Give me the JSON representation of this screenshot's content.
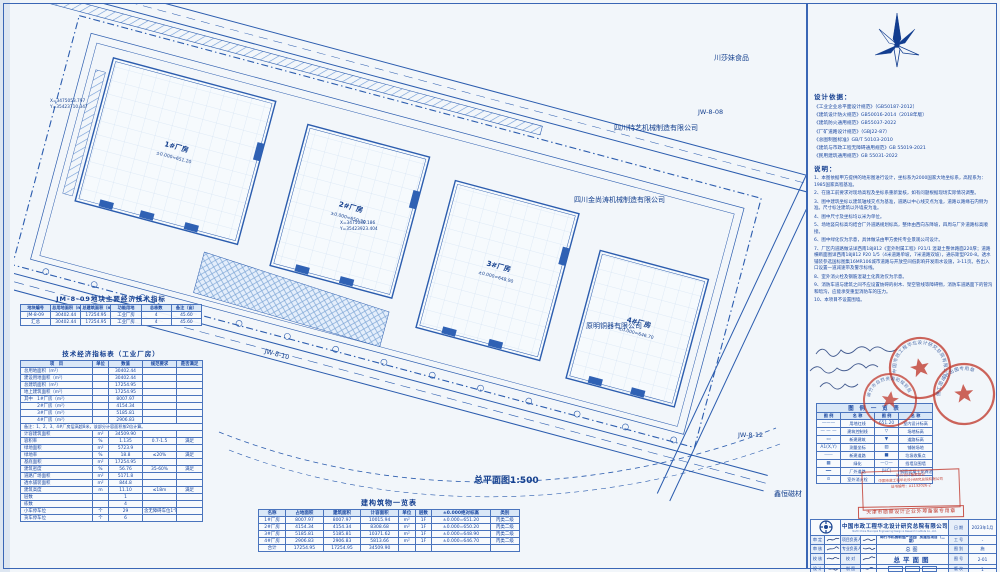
{
  "colors": {
    "line_blue": "#2b5cae",
    "text_navy": "#16418f",
    "stamp_red": "#c13a2e",
    "paper": "#f2f6fa"
  },
  "drawing": {
    "scale_label": "总平面图1:500",
    "neighbors": [
      "川莎妹食品",
      "四川特艺机械制造有限公司",
      "四川金尚涛机械制造有限公司",
      "原明铜器有限公司",
      "鑫恒磁材"
    ],
    "parcels": [
      "JW-8-08",
      "JW-8-10",
      "JW-8-12"
    ],
    "buildings": [
      {
        "name": "1#厂房",
        "elev": "±0.000=651.20"
      },
      {
        "name": "2#厂房",
        "elev": "±0.000=650.20"
      },
      {
        "name": "3#厂房",
        "elev": "±0.000=648.90"
      },
      {
        "name": "4#厂房",
        "elev": "±0.000=646.70"
      }
    ],
    "coords": [
      {
        "x": "X=3475053.797",
        "y": "Y=35423710.347"
      },
      {
        "x": "X=3475039.186",
        "y": "Y=35423923.404"
      }
    ]
  },
  "site_table": {
    "title": "JM-8-09地块主要经济技术指标",
    "headers": [
      "地块编号",
      "总用地面积（m²）",
      "总建筑面积（m²）",
      "功能用地",
      "总栋数",
      "备注（亩）"
    ],
    "rows": [
      [
        "JM-8-09",
        "30402.44",
        "17254.95",
        "工业厂房",
        "4",
        "45.60"
      ],
      [
        "汇总",
        "30402.44",
        "17254.95",
        "工业厂房",
        "4",
        "45.60"
      ]
    ]
  },
  "tech_table": {
    "title": "技术经济指标表（工业厂房）",
    "headers": [
      "项　目",
      "单位",
      "数值",
      "规范要求",
      "是否满足"
    ],
    "rows_a": [
      [
        "总用地面积（m²）",
        "",
        "30402.44",
        "",
        ""
      ],
      [
        "建设用地面积（m²）",
        "",
        "30402.44",
        "",
        ""
      ],
      [
        "总建筑面积（m²）",
        "",
        "17254.95",
        "",
        ""
      ],
      [
        "地上建筑面积（m²）",
        "",
        "17254.95",
        "",
        ""
      ],
      [
        "其中　1#厂房（m²）",
        "",
        "8007.97",
        "",
        ""
      ],
      [
        "　　　2#厂房（m²）",
        "",
        "4154.34",
        "",
        ""
      ],
      [
        "　　　3#厂房（m²）",
        "",
        "5185.81",
        "",
        ""
      ],
      [
        "　　　4#厂房（m²）",
        "",
        "2906.83",
        "",
        ""
      ]
    ],
    "note": "备注：1、2、3、4#厂房层高超8米，该部分计容面积按2倍计算。",
    "rows_b": [
      [
        "计容建筑面积",
        "m²",
        "34509.90",
        "",
        ""
      ],
      [
        "容积率",
        "%",
        "1.135",
        "0.7-1.5",
        "满足"
      ],
      [
        "绿地面积",
        "m²",
        "5723.9",
        "",
        ""
      ],
      [
        "绿地率",
        "%",
        "18.8",
        "≤20%",
        "满足"
      ],
      [
        "基底面积",
        "m²",
        "17254.95",
        "",
        ""
      ],
      [
        "建筑密度",
        "%",
        "56.76",
        "35-60%",
        "满足"
      ],
      [
        "道路广场面积",
        "m²",
        "5171.8",
        "",
        ""
      ],
      [
        "透水铺装面积",
        "m²",
        "844.8",
        "",
        ""
      ],
      [
        "建筑高度",
        "m",
        "11.10",
        "≤18m",
        "满足"
      ],
      [
        "层数",
        "",
        "1",
        "",
        ""
      ],
      [
        "栋数",
        "",
        "4",
        "",
        ""
      ],
      [
        "小车停车位",
        "个",
        "29",
        "含无障碍车位1个",
        ""
      ],
      [
        "货车停车位",
        "个",
        "6",
        "",
        ""
      ]
    ]
  },
  "building_table": {
    "title": "建构筑物一览表",
    "headers": [
      "名称",
      "占地面积",
      "建筑面积",
      "计容面积",
      "单位",
      "层数",
      "±0.000绝对标高",
      "类别"
    ],
    "rows": [
      [
        "1#厂房",
        "8007.97",
        "8007.97",
        "10015.94",
        "m²",
        "1F",
        "±0.000=651.20",
        "丙类二级"
      ],
      [
        "2#厂房",
        "4154.34",
        "4154.34",
        "8308.68",
        "m²",
        "1F",
        "±0.000=650.20",
        "丙类二级"
      ],
      [
        "3#厂房",
        "5185.81",
        "5185.81",
        "10371.62",
        "m²",
        "1F",
        "±0.000=648.90",
        "丙类二级"
      ],
      [
        "4#厂房",
        "2906.83",
        "2906.83",
        "5813.66",
        "m²",
        "1F",
        "±0.000=646.70",
        "丙类二级"
      ],
      [
        "合计",
        "17254.95",
        "17254.95",
        "34509.90",
        "",
        "",
        "",
        ""
      ]
    ]
  },
  "design_basis": {
    "title": "设计依据：",
    "items": [
      "《工业企业总平面设计规范》（GB50187-2012）",
      "《建筑设计防火规范》GB50016-2014（2018年版）",
      "《建筑防火通用规范》GB55037-2022",
      "《厂矿道路设计规范》（GBJ22-87）",
      "《总图制图标准》GB/T 50103-2010",
      "《建筑与市政工程无障碍通用规范》GB 55019-2021",
      "《民用建筑通用规范》GB 55031-2022"
    ]
  },
  "notes": {
    "title": "说明：",
    "items": [
      "1、本图依据甲方提供的地形图进行设计，坐标系为2000国家大地坐标系，高程系为：1985国家高程基准。",
      "2、在施工前要求对现场高程及坐标系重新复核，如有问题根据现场实际情况调整。",
      "3、图中建筑坐标以建筑轴线交点为基准，道路以中心线交点为准，道路以路缘石内侧为准。尺寸标注建筑以外墙皮为准。",
      "4、图中尺寸及坐标均以米为单位。",
      "5、场地竖向标高均结合厂外道路规划标高，整体由西向东降坡，四周与厂外道路标高顺接。",
      "6、图中绿化仅为示意，具体做法由甲方委托专业景观公司设计。",
      "7、厂区内道路做法详西南18J812《室外附属工程》P21/1 混凝土整体路面220厚；道路横断面图详西南18J812 P20 1/5（4米道路单坡，7米道路双坡），通乐斯型P20-8。透水铺装参选国标图集16MR106城市道路与开放空间低影响开发雨水设施，3-11页。各出入口设置一道减速带及警示标线。",
      "8、室外消火栓及钢筋混凝土化粪池仅为示意。",
      "9、消防车道与建筑之间不应设置妨碍的树木、架空管线等障碍物，消防车道路面下的管沟和暗沟，应能承受重型消防车的压力。",
      "10、本项目不设置围墙。"
    ]
  },
  "legend": {
    "title": "图 例 一 览 表",
    "headers": [
      "图 例",
      "名 称",
      "图 例",
      "名 称"
    ],
    "rows": [
      {
        "l_sym": "———",
        "l_name": "用地红线",
        "r_sym": "651.20",
        "r_name": "室内设计标高"
      },
      {
        "l_sym": "— — —",
        "l_name": "建筑控制线",
        "r_sym": "▽",
        "r_name": "场地标高"
      },
      {
        "l_sym": "▭",
        "l_name": "新建建筑",
        "r_sym": "▼",
        "r_name": "道路标高"
      },
      {
        "l_sym": "A1(X,Y)",
        "l_name": "测量坐标",
        "r_sym": "▨",
        "r_name": "铺装场地"
      },
      {
        "l_sym": "┄┄┄",
        "l_name": "新建道路",
        "r_sym": "■",
        "r_name": "垃圾收集点"
      },
      {
        "l_sym": "▩",
        "l_name": "绿化",
        "r_sym": "—○—",
        "r_name": "挡墙及围墙"
      },
      {
        "l_sym": "━━",
        "l_name": "厂外道路",
        "r_sym": "(HC)",
        "r_name": "钢筋混凝土化粪池"
      },
      {
        "l_sym": "⊙",
        "l_name": "室外消火栓",
        "r_sym": "",
        "r_name": ""
      }
    ]
  },
  "stamps": {
    "circle_texts": [
      "中国市政工程华北设计研究总院有限公司",
      "绵竹市自然资源和规划局",
      "施工图设计出图专用章"
    ],
    "box_lines": [
      "进川设计备案登记",
      "中国市政工程华北设计研究总院有限公司",
      "证书编号：A1132026-2"
    ],
    "bar_text": "天津市勘察设计企业外埠备案专用章"
  },
  "title_block": {
    "company": "中国市政工程华北设计研究总院有限公司",
    "company_en": "North China Municipal Engineering Design & Research Institute Co., Ltd.",
    "date_label": "日 期",
    "date": "2023年1月",
    "sign_rows": [
      {
        "role": "审 定",
        "role2": "项目负责人"
      },
      {
        "role": "审 核",
        "role2": "专业负责人"
      },
      {
        "role": "校 核",
        "role2": "校 对"
      },
      {
        "role": "设 计",
        "role2": "制 图"
      }
    ],
    "project_name": "绵竹市机械制造产业园厂房建设项目（二期）",
    "set_name": "总图",
    "sheet_name": "总平面图",
    "right_rows": [
      {
        "label": "工 号",
        "value": "-"
      },
      {
        "label": "图 别",
        "value": "施"
      },
      {
        "label": "图 号",
        "value": "2-01"
      },
      {
        "label": "版 次",
        "value": "1"
      }
    ]
  }
}
